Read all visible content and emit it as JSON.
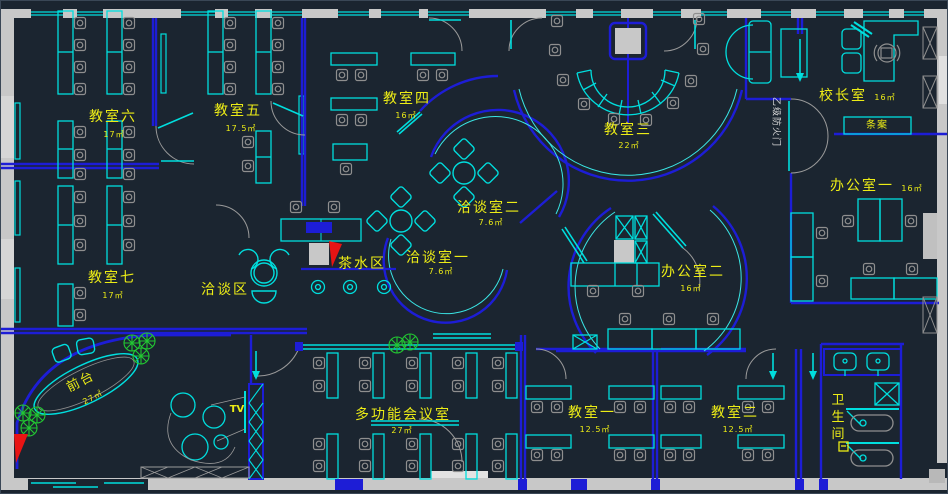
{
  "title": "办公/教学空间平面布置图",
  "colors": {
    "background": "#1b2530",
    "wall_blue": "#1d1dd6",
    "furniture_cyan": "#00dede",
    "chair_gray": "#8f8f8f",
    "exterior_wall_gray": "#c8c8c8",
    "label_yellow": "#ecec16",
    "fire_text_white": "#d8d8d8",
    "plant_green": "#22c832",
    "accent_red": "#e81414"
  },
  "rooms": {
    "classroom6": {
      "name": "教室六",
      "area": "17㎡"
    },
    "classroom5": {
      "name": "教室五",
      "area": "17.5㎡"
    },
    "classroom4": {
      "name": "教室四",
      "area": "16㎡"
    },
    "classroom3": {
      "name": "教室三",
      "area": "22㎡"
    },
    "classroom7": {
      "name": "教室七",
      "area": "17㎡"
    },
    "principal": {
      "name": "校长室",
      "area": "16㎡"
    },
    "office1": {
      "name": "办公室一",
      "area": "16㎡"
    },
    "office2": {
      "name": "办公室二",
      "area": "16㎡"
    },
    "meeting2": {
      "name": "洽谈室二",
      "area": "7.6㎡"
    },
    "meeting1": {
      "name": "洽谈室一",
      "area": "7.6㎡"
    },
    "multi_meeting": {
      "name": "多功能会议室",
      "area": "27㎡"
    },
    "classroom1": {
      "name": "教室一",
      "area": "12.5㎡"
    },
    "classroom2": {
      "name": "教室二",
      "area": "12.5㎡"
    }
  },
  "zones": {
    "tea": {
      "name": "茶水区"
    },
    "talk": {
      "name": "洽谈区"
    },
    "reception": {
      "name": "前台",
      "area": "27㎡"
    },
    "tv": {
      "name": "TV"
    },
    "toilet": {
      "name": "卫生间"
    },
    "console": {
      "name": "条案"
    },
    "fire_door": {
      "name": "乙级防火门"
    }
  }
}
